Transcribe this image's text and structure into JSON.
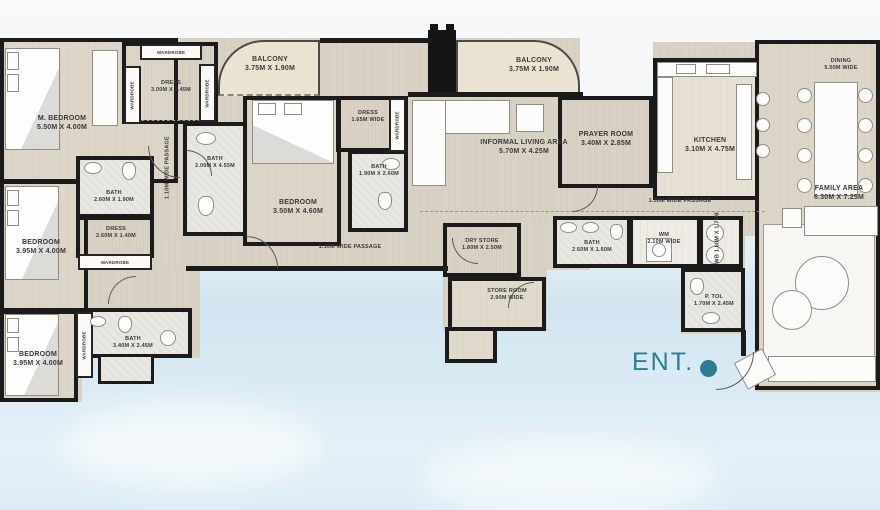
{
  "plan": {
    "title": "apartment-floor-plan",
    "entrance": {
      "label": "ENT."
    },
    "wardrobe_label": "WARDROBE",
    "colors": {
      "accent_teal": "#2c7d92",
      "wall": "#1b1b1b",
      "floor": "#d9d2c4",
      "bath_floor": "#e8e7e2",
      "balcony_floor": "#eae3d1",
      "background_bottom": "#d2e5f0"
    },
    "rooms": {
      "m_bedroom": {
        "name": "M. BEDROOM",
        "dim": "5.50M X 4.00M"
      },
      "dress_master": {
        "name": "DRESS",
        "dim": "3.00M X 2.45M"
      },
      "balcony_left": {
        "name": "BALCONY",
        "dim": "3.75M X 1.90M"
      },
      "balcony_center": {
        "name": "BALCONY",
        "dim": "3.75M X 1.90M"
      },
      "bath_master": {
        "name": "BATH",
        "dim": "2.00M X 4.55M"
      },
      "bedroom_2": {
        "name": "BEDROOM",
        "dim": "3.95M X 4.00M"
      },
      "bath_2": {
        "name": "BATH",
        "dim": "2.60M X 1.90M"
      },
      "dress_2": {
        "name": "DRESS",
        "dim": "2.60M X 1.40M"
      },
      "bedroom_3": {
        "name": "BEDROOM",
        "dim": "3.95M X 4.00M"
      },
      "bath_3": {
        "name": "BATH",
        "dim": "3.40M X 2.45M"
      },
      "bedroom_4": {
        "name": "BEDROOM",
        "dim": "3.50M X 4.60M"
      },
      "dress_4": {
        "name": "DRESS",
        "dim": "1.65M WIDE"
      },
      "bath_4": {
        "name": "BATH",
        "dim": "1.90M X 2.60M"
      },
      "informal_living": {
        "name": "INFORMAL LIVING AREA",
        "dim": "5.70M X 4.25M"
      },
      "prayer_room": {
        "name": "PRAYER ROOM",
        "dim": "3.40M X 2.85M"
      },
      "kitchen": {
        "name": "KITCHEN",
        "dim": "3.10M X 4.75M"
      },
      "dining": {
        "name": "DINING",
        "dim": "5.50M WIDE"
      },
      "family_area": {
        "name": "FAMILY AREA",
        "dim": "6.30M X 7.25M"
      },
      "dry_store": {
        "name": "DRY STORE",
        "dim": "1.80M X 2.50M"
      },
      "store_room": {
        "name": "STORE ROOM",
        "dim": "2.90M WIDE"
      },
      "bath_5": {
        "name": "BATH",
        "dim": "2.60M X 1.60M"
      },
      "wm": {
        "name": "WM",
        "dim": "2.10M WIDE"
      },
      "wb": {
        "name": "WB",
        "dim": "1.60M X 1.70M"
      },
      "p_tol": {
        "name": "P. TOL",
        "dim": "1.70M X 2.45M"
      }
    },
    "passages": {
      "p1": {
        "label": "1.10M WIDE PASSAGE"
      },
      "p2": {
        "label": "1.10M WIDE PASSAGE"
      },
      "p3": {
        "label": "1.30M WIDE PASSAGE"
      }
    }
  }
}
